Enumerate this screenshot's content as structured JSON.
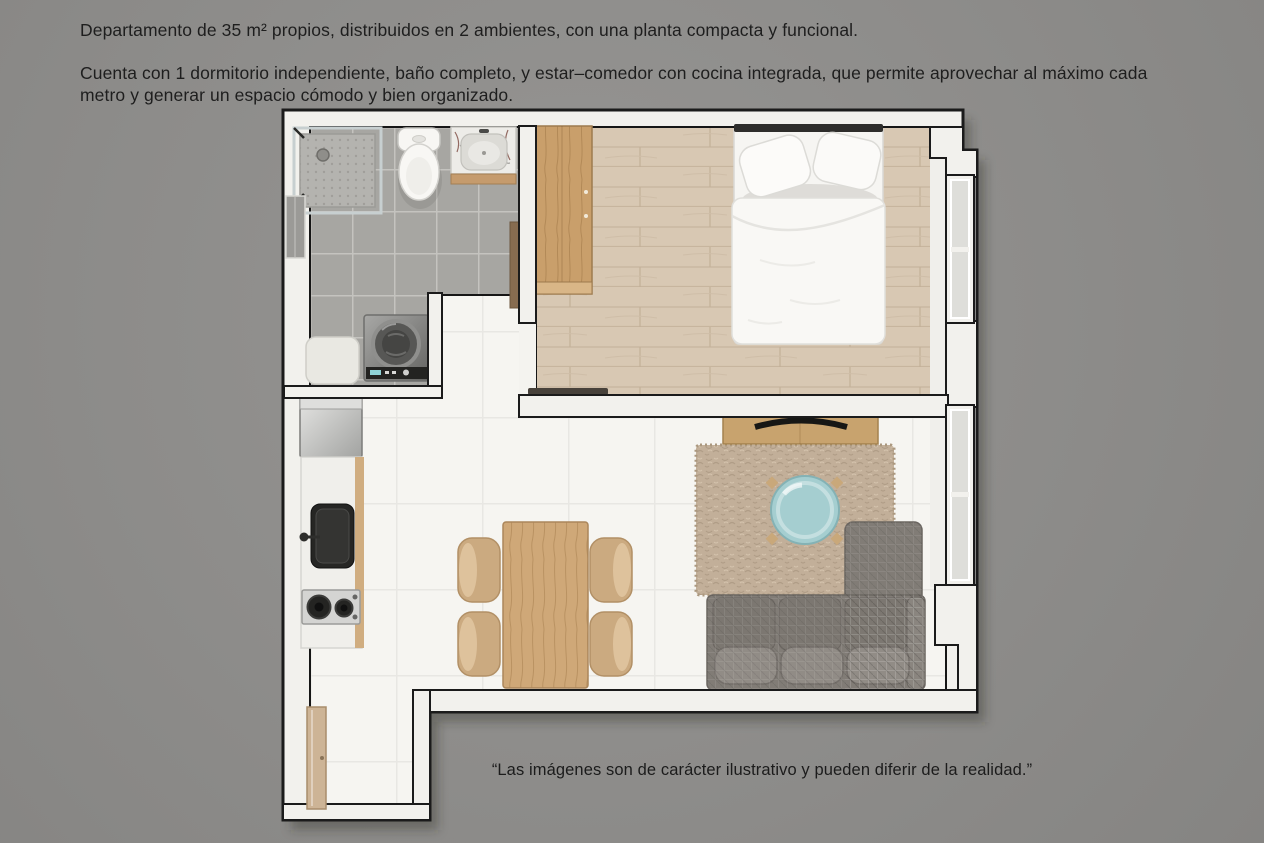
{
  "page": {
    "background_color": "#8d8c8a",
    "text_color": "#1e1e1e"
  },
  "description": {
    "paragraph1": "Departamento de 35 m² propios, distribuidos en 2 ambientes, con una planta compacta y funcional.",
    "paragraph2": "Cuenta con 1 dormitorio independiente, baño completo, y estar–comedor con cocina integrada, que permite aprovechar al máximo cada metro y generar un espacio cómodo y bien organizado."
  },
  "disclaimer": "“Las imágenes son de carácter ilustrativo y pueden diferir de la realidad.”",
  "floorplan": {
    "type": "apartment-top-view-render",
    "rooms": [
      "baño",
      "dormitorio",
      "estar–comedor con cocina integrada",
      "hall de entrada"
    ],
    "elements": [
      "shower",
      "toilet",
      "vanity-sink",
      "washing-machine",
      "laundry-basket",
      "bathroom-door",
      "wardrobe",
      "double-bed",
      "bedroom-window",
      "tv-console",
      "tv",
      "rug",
      "coffee-table",
      "sofa",
      "living-window",
      "refrigerator",
      "kitchen-counter",
      "kitchen-sink",
      "cooktop",
      "dining-table",
      "dining-chair",
      "entry-door"
    ],
    "palette": {
      "wall_fill": "#f2f1ed",
      "wall_outline": "#1b1b1b",
      "bathroom_tile": "#a7a6a2",
      "white_floor": "#f6f5f1",
      "wood_floor": "#d8c8b3",
      "wood_furniture": "#c99f6b",
      "rug": "#c2af99",
      "sofa": "#817c76",
      "coffee_table": "#a5ced0",
      "chair": "#cbaa80",
      "appliance_dark": "#454543",
      "fixture_white": "#f8f7f4"
    }
  }
}
